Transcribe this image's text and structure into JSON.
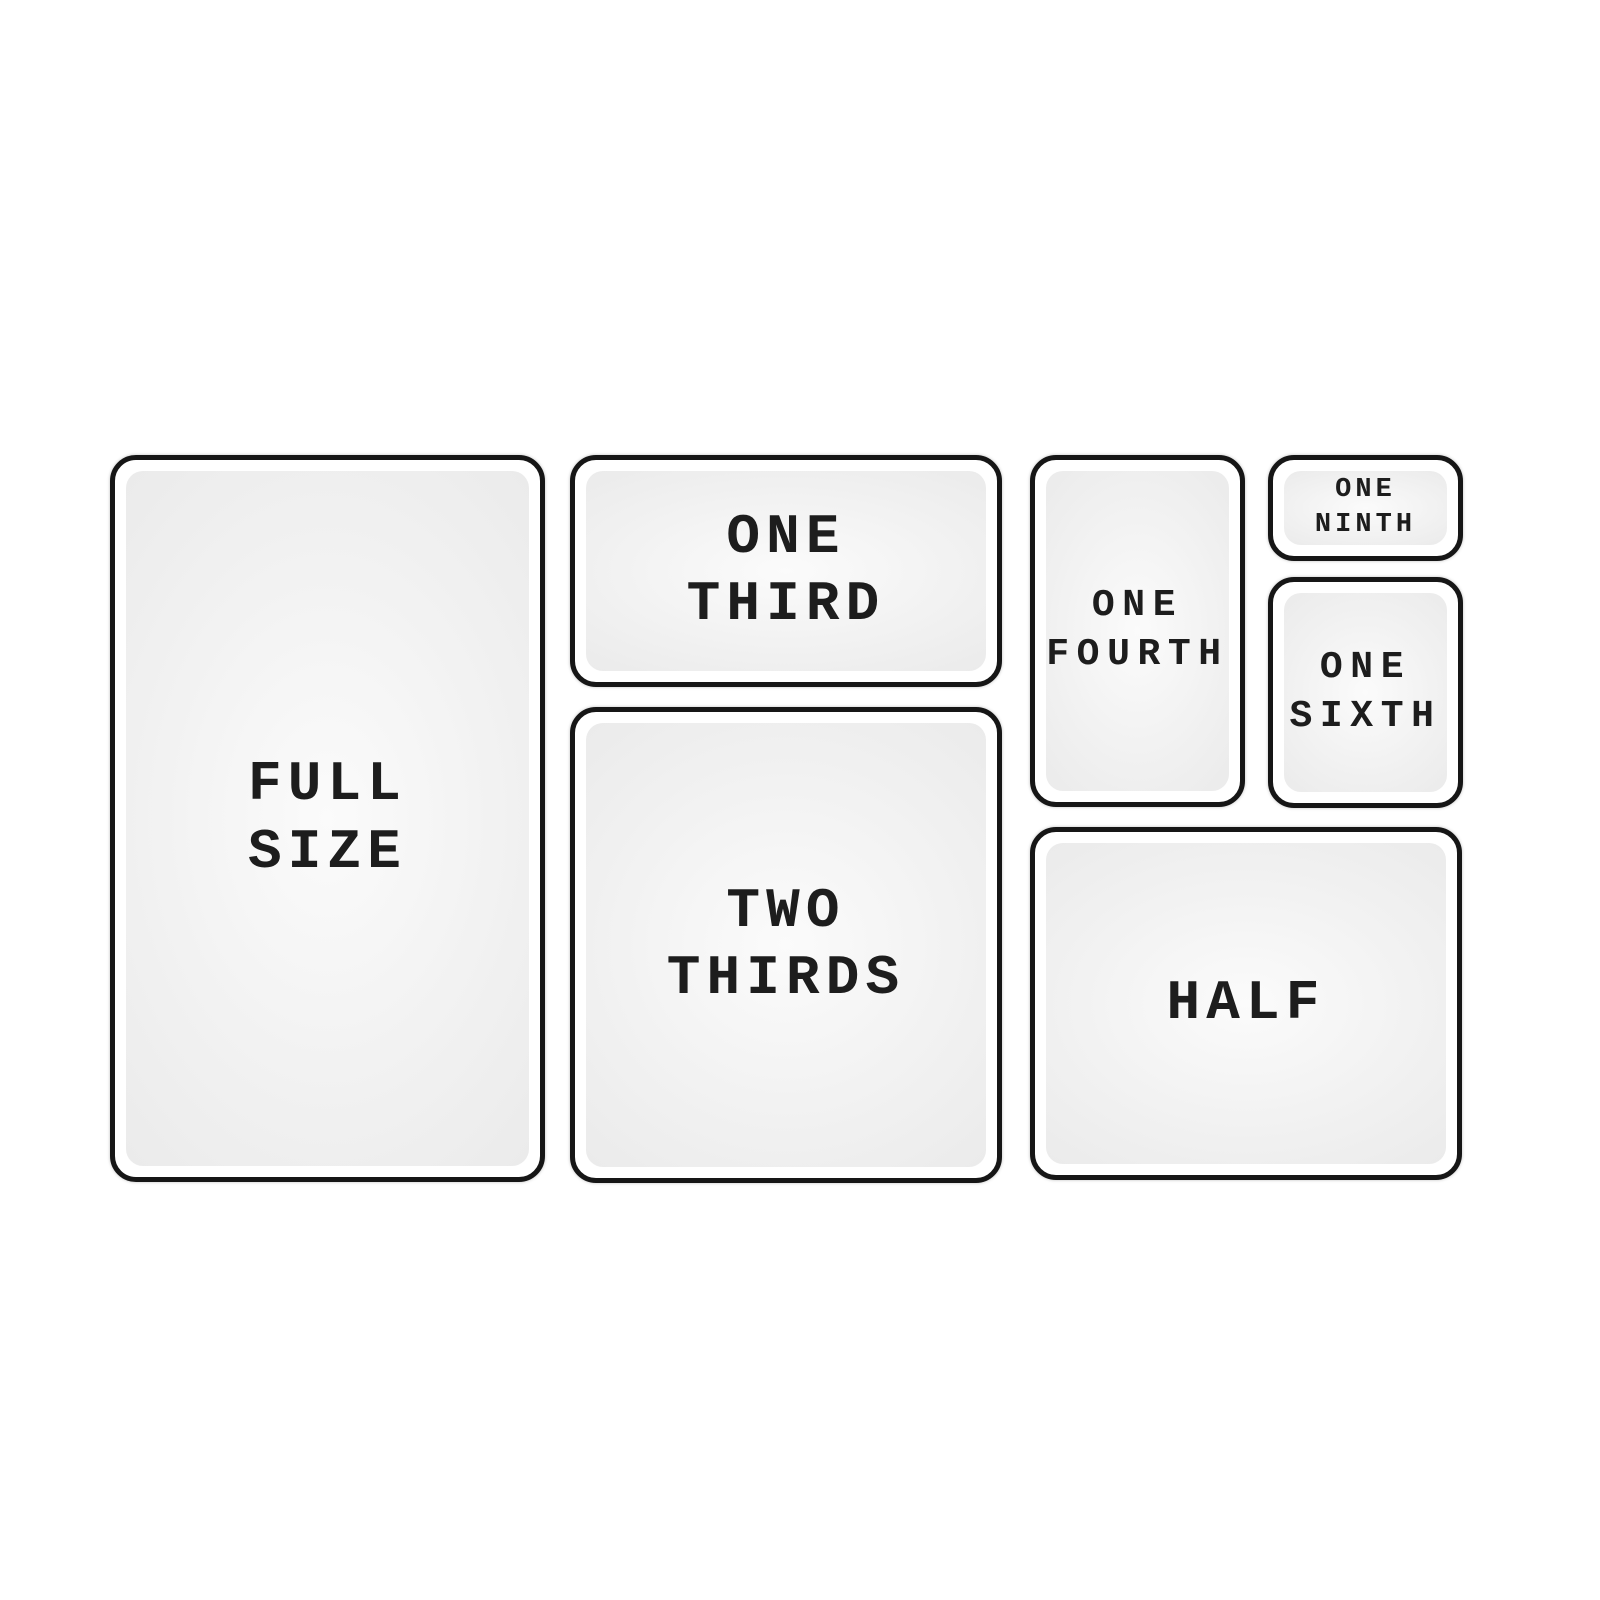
{
  "panels": [
    {
      "id": "full-size",
      "lines": [
        "FULL",
        "SIZE"
      ]
    },
    {
      "id": "one-third",
      "lines": [
        "ONE",
        "THIRD"
      ]
    },
    {
      "id": "two-thirds",
      "lines": [
        "TWO",
        "THIRDS"
      ]
    },
    {
      "id": "one-fourth",
      "lines": [
        "ONE",
        "FOURTH"
      ]
    },
    {
      "id": "one-ninth",
      "lines": [
        "ONE",
        "NINTH"
      ]
    },
    {
      "id": "one-sixth",
      "lines": [
        "ONE",
        "SIXTH"
      ]
    },
    {
      "id": "half",
      "lines": [
        "HALF"
      ]
    }
  ],
  "colors": {
    "background": "#ffffff",
    "border": "#161616",
    "panel_fill": "#ebebeb",
    "panel_glow": "#fbfbfb",
    "text": "#1d1d1d"
  }
}
